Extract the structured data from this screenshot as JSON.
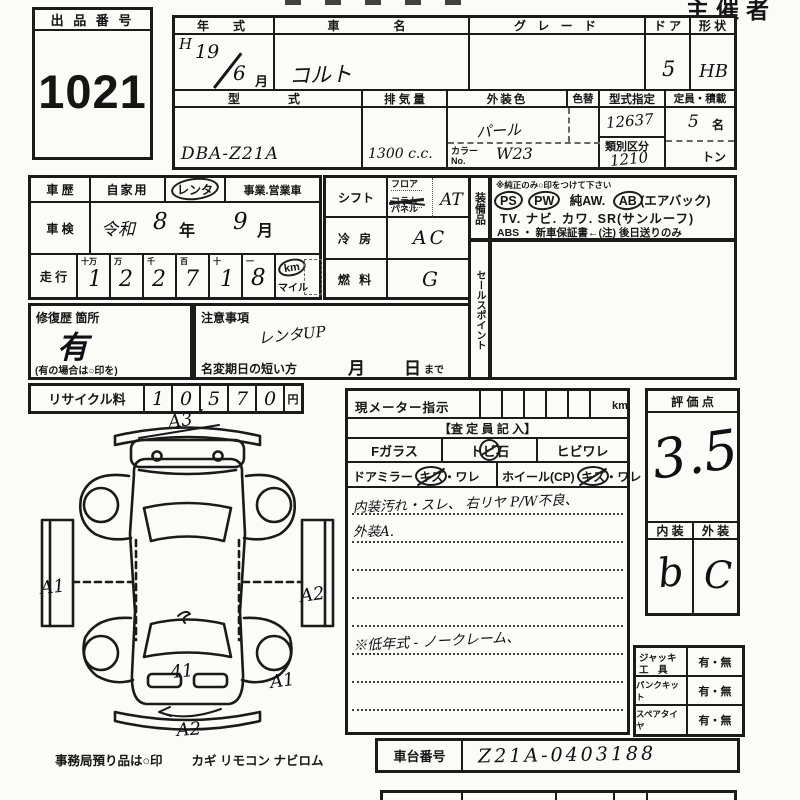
{
  "header": {
    "stamp": "主催者用"
  },
  "lot": {
    "label": "出 品 番 号",
    "number": "1021"
  },
  "top1": {
    "year_label": "年　式",
    "era": "H",
    "year": "19",
    "month": "6",
    "month_unit": "月",
    "name_label": "車　　名",
    "name": "コルト",
    "grade_label": "グ レ ー ド",
    "door_label": "ド ア",
    "door": "5",
    "shape_label": "形 状",
    "shape": "HB"
  },
  "top2": {
    "model_label": "型　　式",
    "model": "DBA-Z21A",
    "disp_label": "排 気 量",
    "disp": "1300 c.c.",
    "color_label": "外装色",
    "color": "パール",
    "color_change_label": "色替",
    "color_no_label1": "カラー",
    "color_no_label2": "No.",
    "color_no": "W23",
    "desig_label": "型式指定",
    "desig": "12637",
    "class_label": "類別区分",
    "class_no": "1210",
    "cap_label": "定員・積載",
    "cap": "5",
    "cap_unit": "名",
    "load": "トン"
  },
  "history": {
    "label": "車 歴",
    "opt1": "自家用",
    "opt2": "レンタ",
    "opt3": "事業.営業車"
  },
  "shaken": {
    "label": "車 検",
    "era": "令和",
    "year": "8",
    "y_unit": "年",
    "month": "9",
    "m_unit": "月"
  },
  "mileage": {
    "label": "走 行",
    "cols": [
      "十万",
      "万",
      "千",
      "百",
      "十",
      "一"
    ],
    "digits": [
      "1",
      "2",
      "2",
      "7",
      "1",
      "8"
    ],
    "unit": "km",
    "unit2": "マイル"
  },
  "repair": {
    "label": "修復歴 箇所",
    "value": "有",
    "note": "(有の場合は○印を)"
  },
  "caution": {
    "label": "注意事項",
    "value": "レンタUP",
    "rename_label": "名変期日の短い方",
    "m": "月",
    "d": "日",
    "made": "まで"
  },
  "recycle": {
    "label": "リサイクル料",
    "digits": [
      "1",
      "0",
      "5",
      "7",
      "0"
    ],
    "comma": ",",
    "unit": "円"
  },
  "shift": {
    "label": "シフト",
    "opt1": "フロア",
    "opt2": "コラム",
    "opt3": "パネル",
    "value": "AT"
  },
  "cooling": {
    "label": "冷 房",
    "value": "AC"
  },
  "fuel": {
    "label": "燃 料",
    "value": "G"
  },
  "equip": {
    "label": "装備品",
    "note": "※純正のみ○印をつけて下さい",
    "ps": "PS",
    "pw": "PW",
    "aw": "純AW.",
    "ab": "AB",
    "ab_note": "(エアバック)",
    "line2": "TV. ナビ. カワ. SR(サンルーフ)",
    "line3": "ABS ・ 新車保証書←(注) 後日送りのみ"
  },
  "sales": {
    "label": "セールスポイント"
  },
  "meter": {
    "label": "現メーター指示",
    "unit": "km"
  },
  "assess": {
    "header": "【査 定 員 記 入】",
    "fglass": "Fガラス",
    "tobi1": "ト",
    "tobi2": "ビ",
    "tobi3": "石",
    "hibi": "ヒビワレ",
    "mirror": "ドアミラー",
    "m_kizu": "キズ",
    "m_ware": "・ワレ",
    "wheel": "ホイール(CP)",
    "w_kizu": "キズ",
    "w_ware": "・ワレ",
    "note1": "内装汚れ・スレ、 右リヤ P/W不良、",
    "note2": "外装A.",
    "note3": "※低年式 - ノークレーム、"
  },
  "rating": {
    "label": "評 価 点",
    "score": "3.5",
    "int_label": "内 装",
    "ext_label": "外 装",
    "interior": "b",
    "exterior": "C"
  },
  "tools": {
    "t1a": "ジャッキ",
    "t1b": "工　具",
    "v1": "有・無",
    "t2": "パンクキット",
    "v2": "有・無",
    "t3": "スペアタイヤ",
    "v3": "有・無"
  },
  "chassis": {
    "label": "車台番号",
    "value": "Z21A-0403188"
  },
  "footer": {
    "note": "事務局預り品は○印",
    "items": "カギ  リモコン  ナビロム"
  },
  "diagram": {
    "a3": "A3",
    "a1_left": "A1",
    "a2_right": "A2",
    "center_mark": "41",
    "a1_br": "A1",
    "a2_bottom": "A2"
  }
}
